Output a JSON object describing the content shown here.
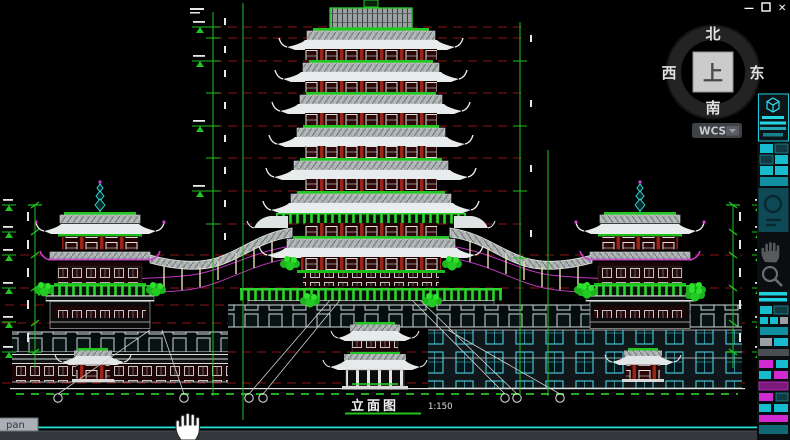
{
  "window_controls": {
    "minimize": "—",
    "close": "✕"
  },
  "viewcube": {
    "north": "北",
    "south": "南",
    "west": "西",
    "east": "东",
    "top_face": "上"
  },
  "wcs": {
    "label": "WCS"
  },
  "drawing": {
    "title": "立面图",
    "scale": "1:150"
  },
  "status": {
    "pan_tooltip": "pan"
  },
  "colors": {
    "background": "#000000",
    "grid_green": "#21c421",
    "datum_red": "#8c1414",
    "accent_cyan": "#25dfd2",
    "magenta": "#c535c5",
    "roof_gray": "#b3b8b8",
    "column_red": "#9c2418",
    "ui_cyan": "#19c9da",
    "ui_magenta": "#d02ad0"
  }
}
